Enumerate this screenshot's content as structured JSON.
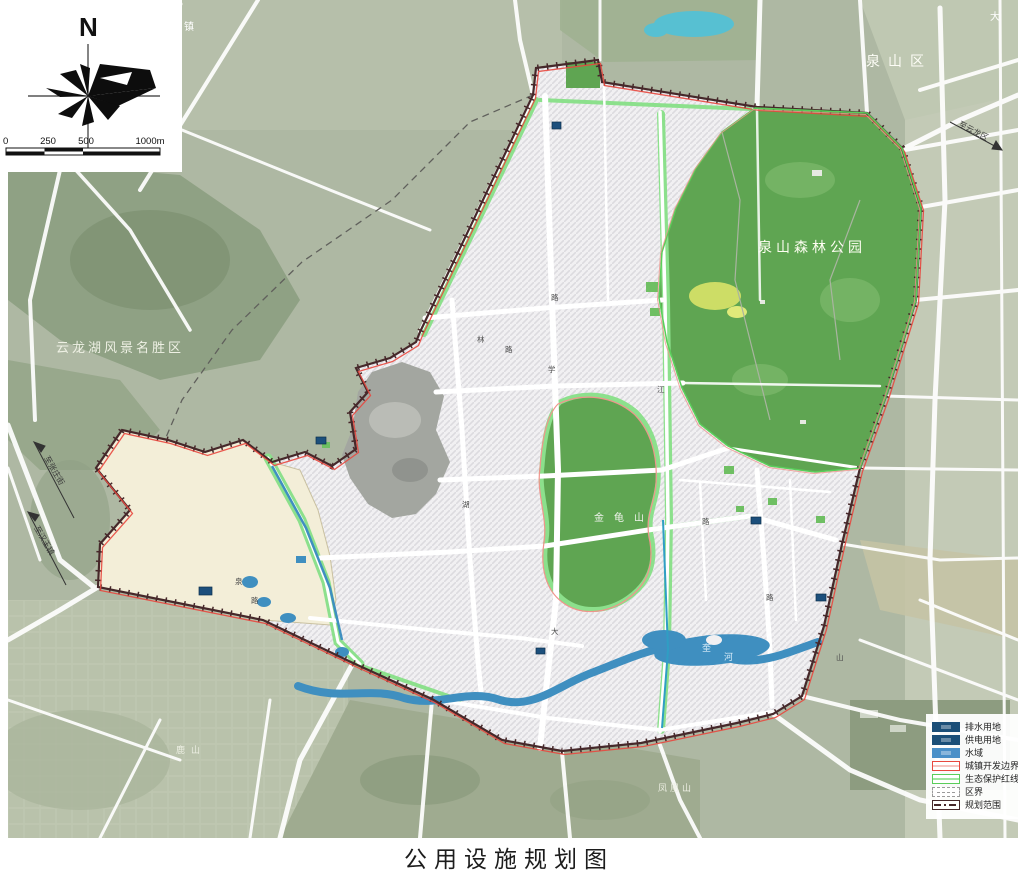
{
  "title": "公用设施规划图",
  "compass": {
    "north": "N"
  },
  "scale_bar": {
    "ticks": [
      "0",
      "250",
      "500",
      "1000m"
    ]
  },
  "legend": {
    "items": [
      {
        "label": "排水用地",
        "swatch": "fill",
        "color": "#1b4f78"
      },
      {
        "label": "供电用地",
        "swatch": "fill",
        "color": "#1b4f78"
      },
      {
        "label": "水域",
        "swatch": "fill",
        "color": "#4a90c8"
      },
      {
        "label": "城镇开发边界",
        "swatch": "line",
        "color": "#e8483f",
        "inner": "#f6c6c2"
      },
      {
        "label": "生态保护红线",
        "swatch": "line",
        "color": "#5ace5a",
        "inner": "#9fe69f"
      },
      {
        "label": "区界",
        "swatch": "dashed",
        "color": "#9a9a9a"
      },
      {
        "label": "规划范围",
        "swatch": "dashdot",
        "color": "#46282a"
      }
    ]
  },
  "map": {
    "area_labels": [
      {
        "text": "泉山区",
        "x": 866,
        "y": 66,
        "size": 14,
        "ls": 8,
        "color": "#fdfdf6"
      },
      {
        "text": "云龙湖风景名胜区",
        "x": 56,
        "y": 352,
        "size": 13,
        "ls": 3,
        "color": "#eef0e4"
      },
      {
        "text": "泉山森林公园",
        "x": 758,
        "y": 252,
        "size": 14,
        "ls": 4,
        "color": "#fefef2"
      },
      {
        "text": "金龟山",
        "x": 594,
        "y": 521,
        "size": 10,
        "ls": 10,
        "color": "#f2f4ee"
      },
      {
        "text": "鹿山",
        "x": 176,
        "y": 753,
        "size": 9,
        "ls": 6,
        "color": "#eceee2"
      },
      {
        "text": "凤凰山",
        "x": 658,
        "y": 791,
        "size": 9,
        "ls": 3,
        "color": "#eceee2"
      },
      {
        "text": "大",
        "x": 990,
        "y": 20,
        "size": 10,
        "ls": 0,
        "color": "#ffffff"
      },
      {
        "text": "镇",
        "x": 184,
        "y": 30,
        "size": 10,
        "ls": 0,
        "color": "#ffffff"
      }
    ],
    "water_labels": [
      {
        "text": "奎",
        "x": 702,
        "y": 651
      },
      {
        "text": "河",
        "x": 724,
        "y": 660
      }
    ],
    "edge_labels": [
      {
        "text": "至张庄街",
        "x": 44,
        "y": 458,
        "rot": 60
      },
      {
        "text": "至汉王镇",
        "x": 34,
        "y": 528,
        "rot": 60
      },
      {
        "text": "至云龙区",
        "x": 958,
        "y": 126,
        "rot": 27
      }
    ],
    "road_labels": [
      {
        "text": "林",
        "x": 477,
        "y": 342
      },
      {
        "text": "路",
        "x": 505,
        "y": 352
      },
      {
        "text": "学",
        "x": 548,
        "y": 372
      },
      {
        "text": "路",
        "x": 551,
        "y": 300
      },
      {
        "text": "江",
        "x": 657,
        "y": 392
      },
      {
        "text": "大",
        "x": 551,
        "y": 634
      },
      {
        "text": "泉",
        "x": 235,
        "y": 584
      },
      {
        "text": "路",
        "x": 251,
        "y": 603
      },
      {
        "text": "湖",
        "x": 462,
        "y": 507
      },
      {
        "text": "路",
        "x": 702,
        "y": 524
      },
      {
        "text": "山",
        "x": 836,
        "y": 660
      },
      {
        "text": "路",
        "x": 766,
        "y": 600
      }
    ],
    "facilities": [
      {
        "x": 199,
        "y": 587,
        "w": 13,
        "h": 8
      },
      {
        "x": 316,
        "y": 437,
        "w": 10,
        "h": 7
      },
      {
        "x": 552,
        "y": 122,
        "w": 9,
        "h": 7
      },
      {
        "x": 751,
        "y": 517,
        "w": 10,
        "h": 7
      },
      {
        "x": 816,
        "y": 594,
        "w": 10,
        "h": 7
      },
      {
        "x": 536,
        "y": 648,
        "w": 9,
        "h": 6
      }
    ]
  },
  "colors": {
    "water": "#3f8fc0",
    "forest": "#5fa552",
    "ribbon": "#8ce08c",
    "cream": "#f3eed8",
    "boundary_dark": "#46282a",
    "dev_boundary_red": "#e8483f",
    "eco_line_green": "#5ace5a",
    "facility_blue": "#1c4f7c"
  }
}
